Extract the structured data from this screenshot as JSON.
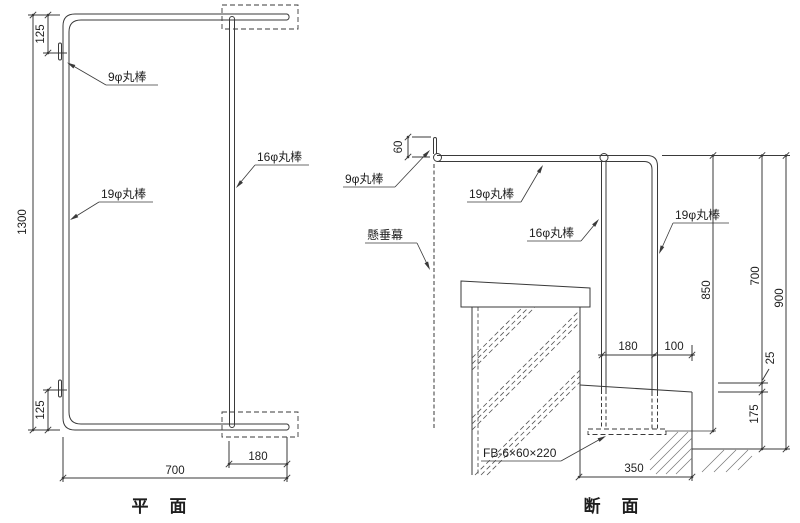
{
  "ink_color": "#3a3a3a",
  "background_color": "#ffffff",
  "plan": {
    "title": "平　面",
    "labels": {
      "rod9": "9φ丸棒",
      "rod19": "19φ丸棒",
      "rod16": "16φ丸棒"
    },
    "dims": {
      "total_height": "1300",
      "top_hook_offset": "125",
      "bottom_hook_offset": "125",
      "width": "700",
      "end_extension": "180"
    }
  },
  "section": {
    "title": "断　面",
    "labels": {
      "rod9": "9φ丸棒",
      "rod19_top": "19φ丸棒",
      "rod16": "16φ丸棒",
      "rod19_vert": "19φ丸棒",
      "banner": "懸垂幕",
      "flat_bar": "FB-6×60×220"
    },
    "dims": {
      "hook_height": "60",
      "rod_spacing": "180",
      "edge_offset": "100",
      "rod_bottom_height": "850",
      "clear_height": "700",
      "overall_height": "900",
      "slope_drop": "25",
      "curb_height": "175",
      "curb_width": "350"
    }
  }
}
